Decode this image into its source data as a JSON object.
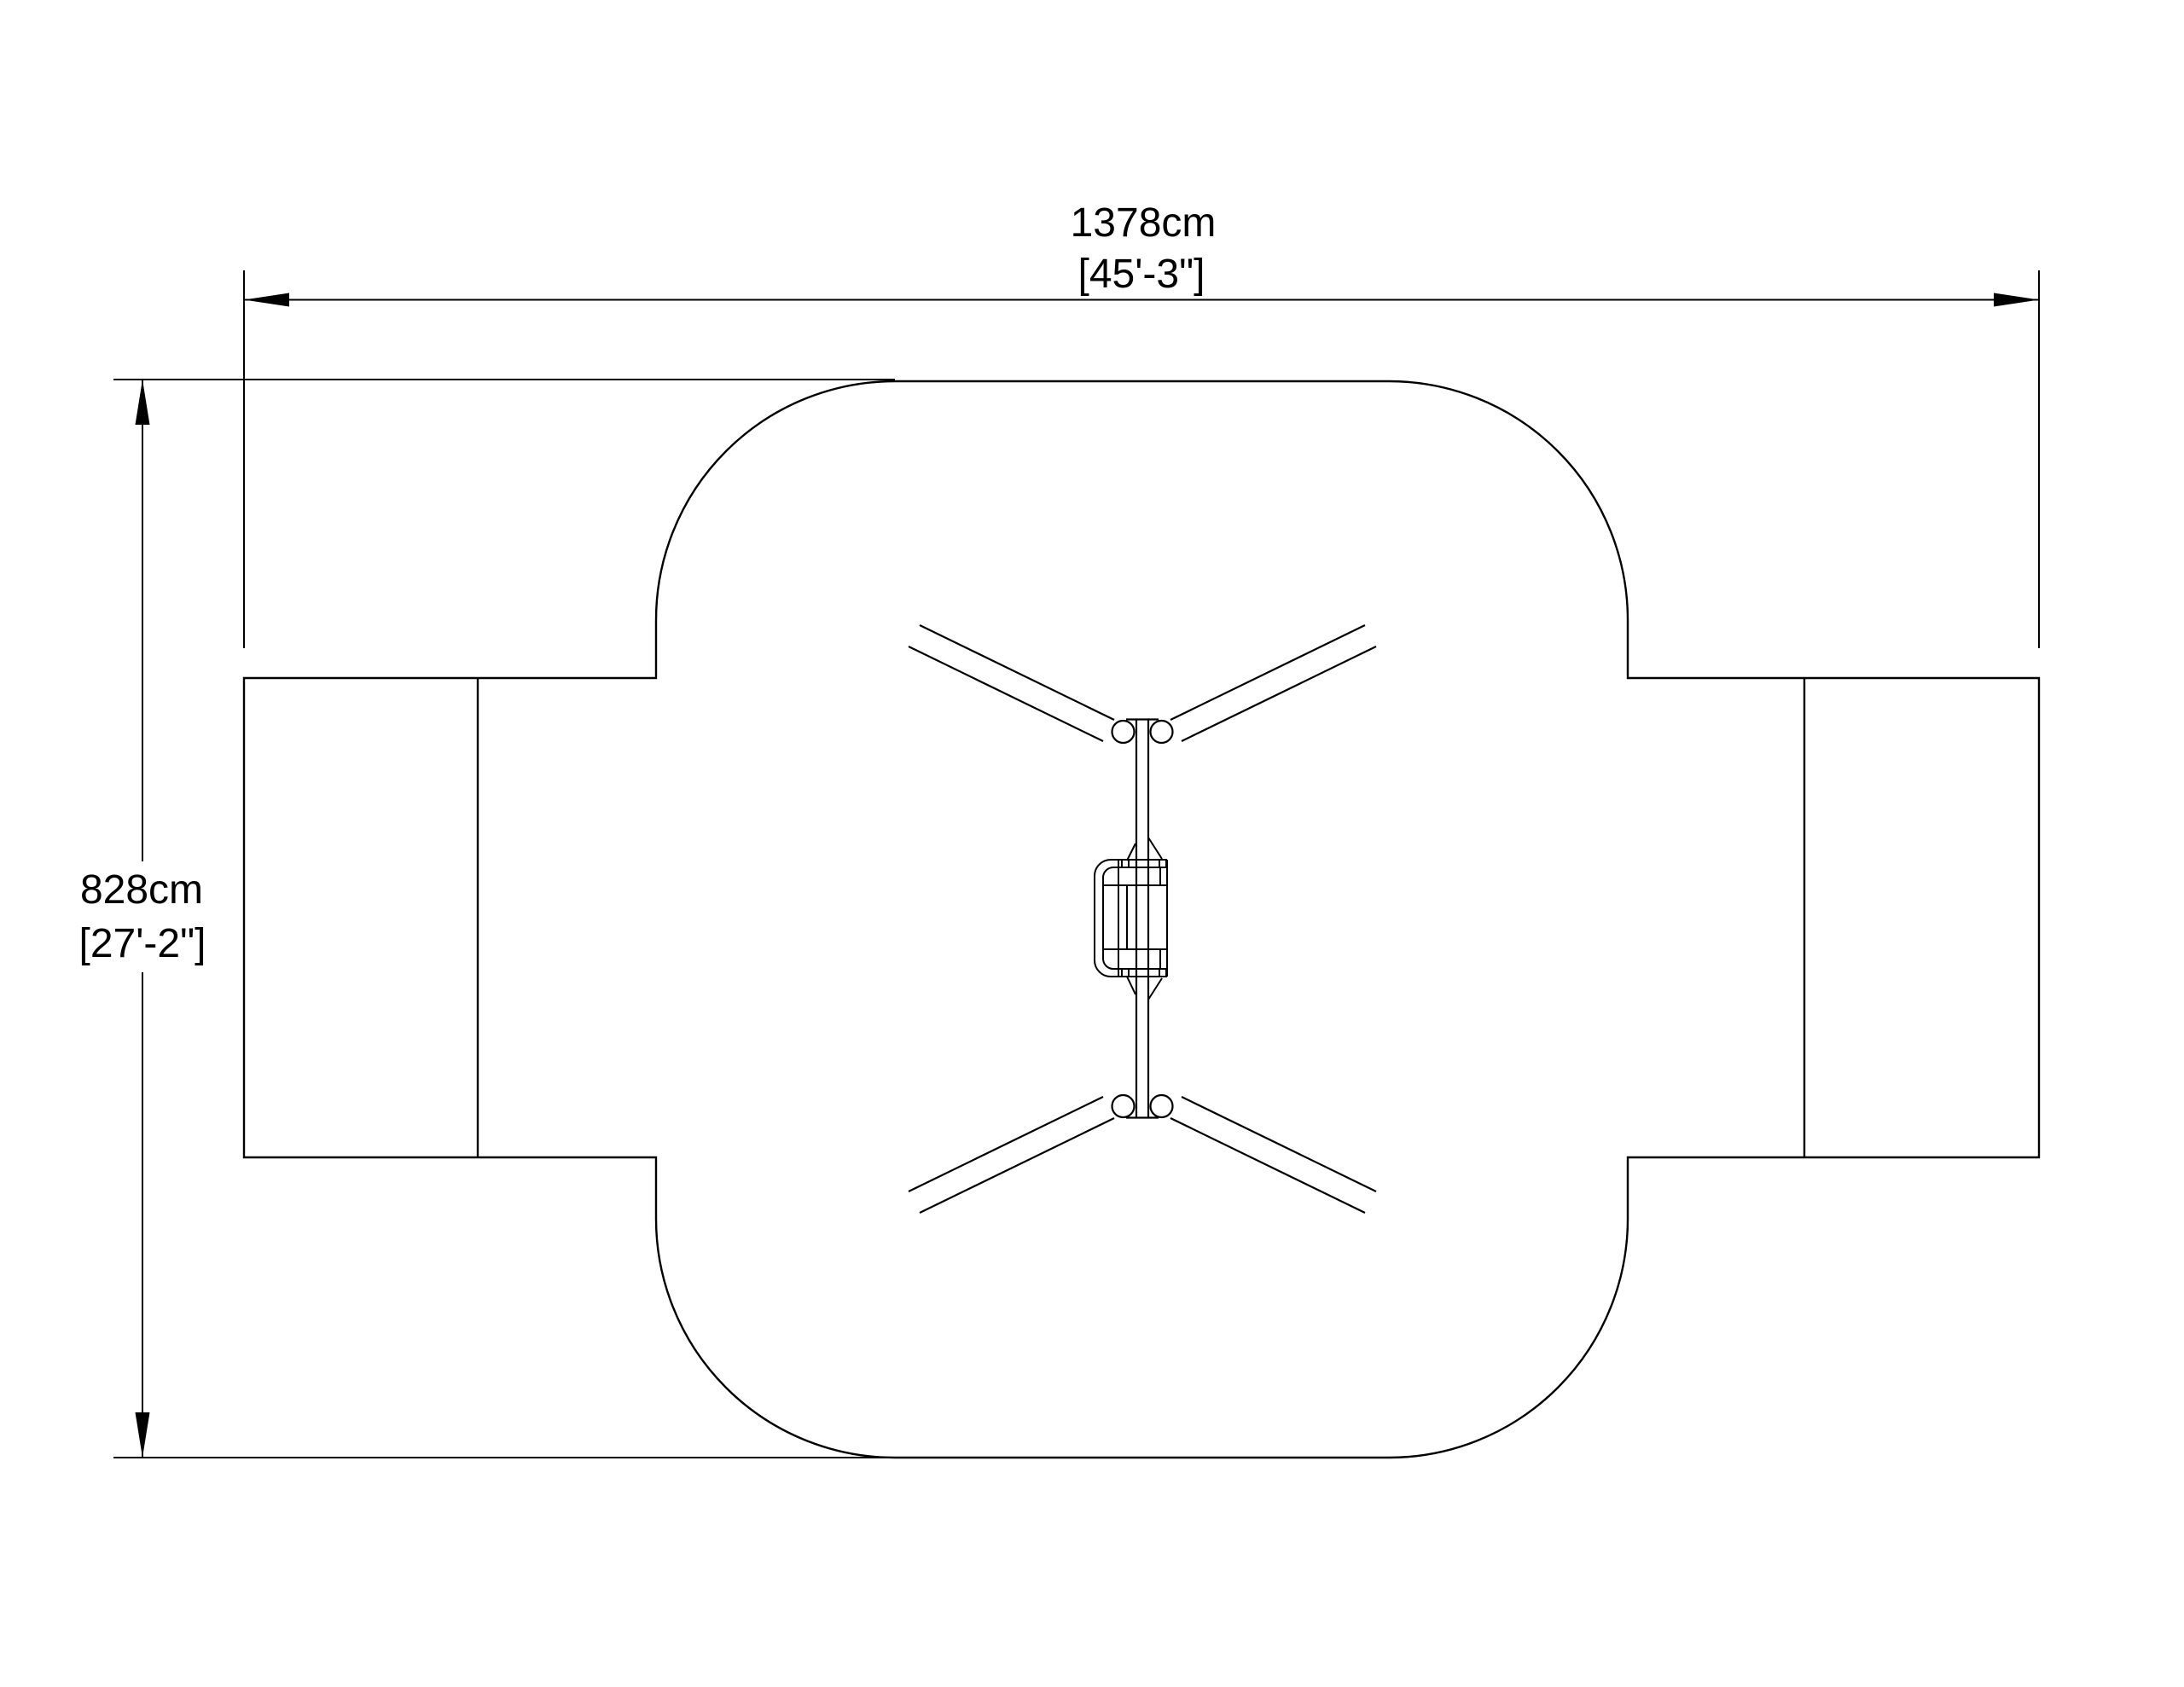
{
  "sheet": {
    "background": "#ffffff",
    "line_color": "#000000",
    "text_color": "#000000"
  },
  "dimensions": {
    "width": {
      "metric": "1378cm",
      "imperial": "[45'-3\"]"
    },
    "height": {
      "metric": "828cm",
      "imperial": "[27'-2\"]"
    }
  }
}
